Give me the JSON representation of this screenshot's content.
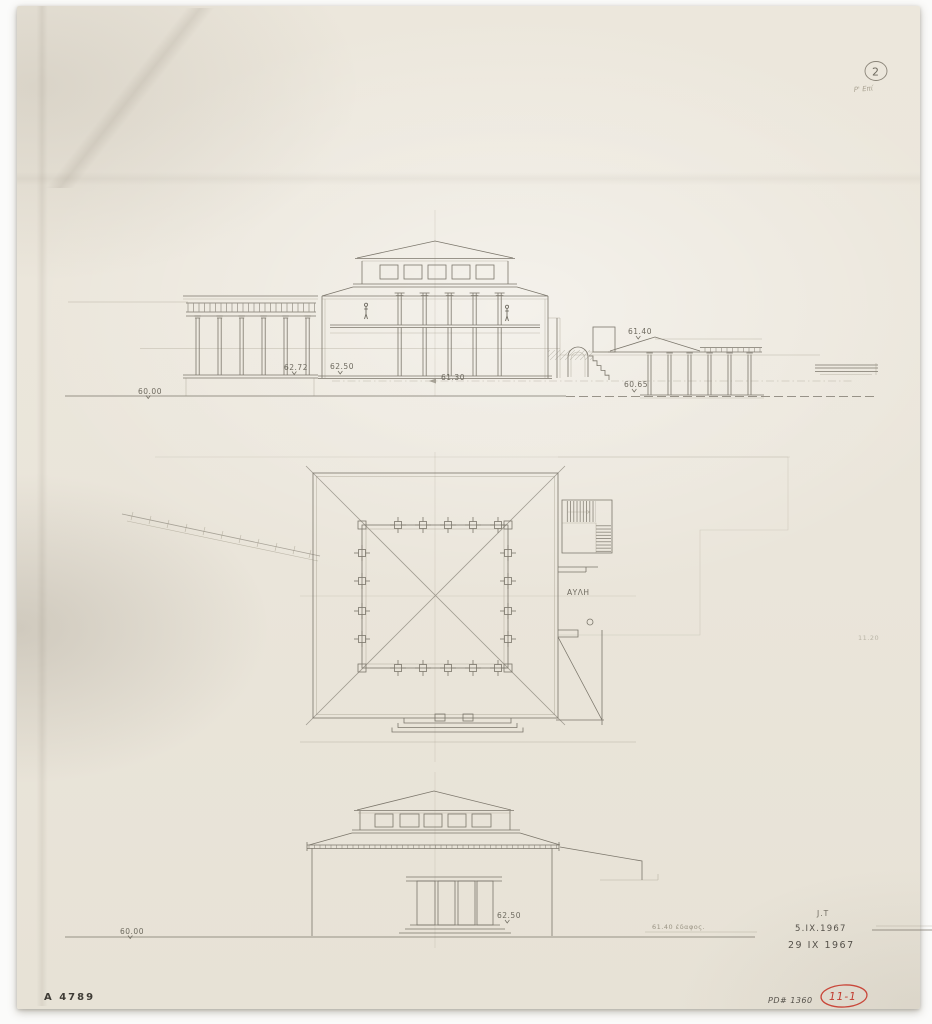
{
  "sheet": {
    "paper_color": "#eae5da",
    "pencil_color": "#7b766b",
    "red_ink_color": "#c23b2e"
  },
  "marks": {
    "sheet_number": "2",
    "sheet_number_note": "P' Επί",
    "inventory_number": "A 4789",
    "drawing_number": "PD# 1360",
    "red_index_number": "11-1",
    "draftsman_initials": "J.T",
    "date_first": "5.IX.1967",
    "date_second": "29 IX 1967"
  },
  "section_view": {
    "levels": {
      "stoa_roof_right": "61.40",
      "left_terrace": "62.72",
      "main_floor": "62.50",
      "mid_terrace": "61.30",
      "right_stoa_floor": "60.65",
      "ground": "60.00"
    }
  },
  "plan_view": {
    "courtyard_label": "ΑΥΛΗ",
    "dimension_note": "11.20"
  },
  "elevation_view": {
    "levels": {
      "porch_floor": "62.50",
      "ground": "60.00"
    },
    "ground_note": "61.40 έδαφος."
  }
}
